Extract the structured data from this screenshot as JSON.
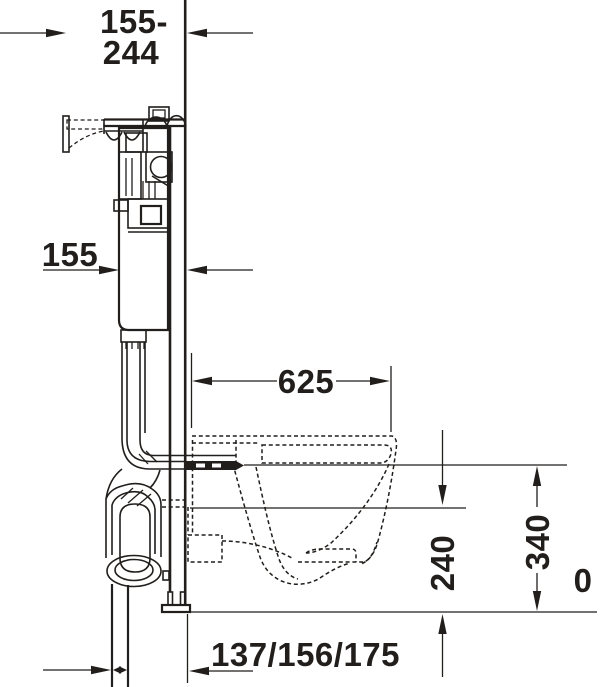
{
  "diagram": {
    "type": "technical-installation-drawing",
    "subject": "wall-hung toilet with concealed cistern mounting frame, side section view",
    "line_color": "#211e1c",
    "background_color": "#ffffff",
    "dimensions": {
      "top_range": {
        "line1": "155-",
        "line2": "244"
      },
      "left_depth": "155",
      "middle_projection": "625",
      "right_inner_height": "240",
      "right_outer_height": "340",
      "floor_reference": "0",
      "bottom_offsets": "137/156/175"
    }
  }
}
